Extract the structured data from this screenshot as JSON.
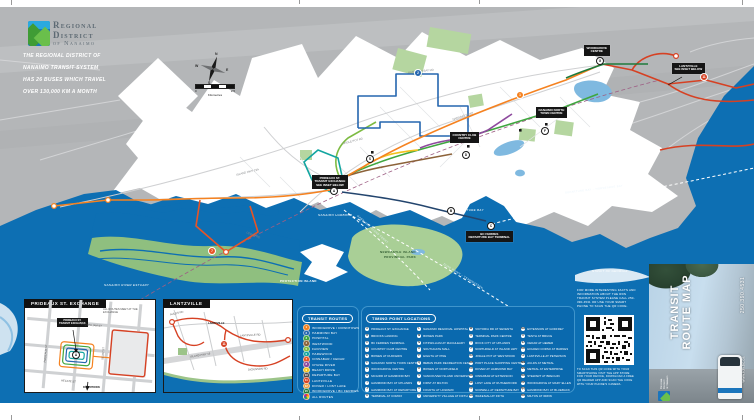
{
  "brand": {
    "line1": "Regional",
    "line2": "District",
    "line3": "of Nanaimo",
    "tagline": [
      "THE REGIONAL DISTRICT OF",
      "NANAIMO TRANSIT SYSTEM",
      "HAS 26 BUSES WHICH TRAVEL",
      "OVER 130,000 KM A MONTH"
    ]
  },
  "map": {
    "compass": {
      "n": "N",
      "e": "E",
      "s": "S",
      "w": "W"
    },
    "scale": {
      "zero": "0",
      "max": "2.5",
      "unit": "Kilometres"
    },
    "callouts": {
      "prideaux": {
        "l1": "PRIDEAUX ST.",
        "l2": "TRANSIT EXCHANGE",
        "l3": "SEE INSET BELOW"
      },
      "lantzville": {
        "l1": "LANTZVILLE",
        "l2": "SEE INSET BELOW"
      },
      "bcferries": {
        "l1": "BC FERRIES",
        "l2": "DEPARTURE BAY TERMINAL"
      },
      "woodgrove": {
        "l1": "WOODGROVE",
        "l2": "CENTRE"
      },
      "ntc": {
        "l1": "NANAIMO NORTH",
        "l2": "TOWN CENTRE"
      },
      "ccc": {
        "l1": "COUNTRY CLUB",
        "l2": "CENTRE"
      }
    },
    "water": {
      "harbour": "NANAIMO HARBOUR",
      "departure_bay": "DEPARTURE BAY",
      "newcastle1": "NEWCASTLE ISLAND",
      "newcastle2": "PROVINCIAL PARK",
      "protection": "PROTECTION ISLAND",
      "estuary": "NANAIMO RIVER ESTUARY",
      "strait": "STRAIT OF GEORGIA"
    },
    "ferry": {
      "f1": "DEPARTURE BAY – HORSESHOE BAY",
      "f2": "DUKE POINT – TSAWWASSEN",
      "f3": "GABRIOLA ISLAND FERRY"
    },
    "roads": {
      "island_hwy": "ISLAND HWY 19A",
      "parkway": "NANAIMO PKWY",
      "hammond_bay": "HAMMOND BAY RD",
      "cedar": "CEDAR RD",
      "jingle_pot": "JINGLE POT RD"
    },
    "markers": {
      "a": "A",
      "b": "B",
      "c": "C",
      "d": "D",
      "f": "F",
      "g": "G",
      "s": "S"
    },
    "badges": {
      "r1": "1",
      "r2": "2",
      "r7": "7",
      "r11": "11"
    }
  },
  "insets": [
    {
      "title": "PRIDEAUX ST. EXCHANGE",
      "marker": "A",
      "box1": "PRIDEAUX ST.",
      "box2": "TRANSIT EXCHANGE",
      "note": "ALL ROUTES MEET AT THE EXCHANGE",
      "downtown": "DOWNTOWN",
      "streets": {
        "fitzwilliam": "FITZWILLIAM ST",
        "prideaux": "PRIDEAUX ST",
        "selby": "SELBY ST",
        "hecate": "HECATE ST"
      }
    },
    {
      "title": "LANTZVILLE",
      "village": "LANTZVILLE",
      "badge": "11",
      "streets": {
        "lantzville_rd": "LANTZVILLE RD",
        "aulds": "AULDS RD",
        "dickinson": "DICKINSON RD",
        "island_hwy": "ISLAND HWY 19"
      }
    }
  ],
  "legend": {
    "routes": {
      "header": "TRANSIT ROUTES",
      "items": [
        {
          "num": "1",
          "label": "WOODGROVE / DOWNTOWN",
          "color": "#F58220"
        },
        {
          "num": "2",
          "label": "HAMMOND BAY",
          "color": "#2566AF"
        },
        {
          "num": "3",
          "label": "HOSPITAL",
          "color": "#3FA63F"
        },
        {
          "num": "4",
          "label": "WESTWOOD",
          "color": "#8C6239"
        },
        {
          "num": "5",
          "label": "FAIRVIEW",
          "color": "#7DBB42"
        },
        {
          "num": "6",
          "label": "HAREWOOD",
          "color": "#12A5A0"
        },
        {
          "num": "7",
          "label": "CINNABAR / CEDAR",
          "color": "#E85425"
        },
        {
          "num": "8",
          "label": "CHASE RIVER",
          "color": "#8E4A9E"
        },
        {
          "num": "9",
          "label": "BEACH DRIVE",
          "color": "#F2C21E"
        },
        {
          "num": "10",
          "label": "DEPARTURE BAY",
          "color": "#4A4A4C"
        },
        {
          "num": "11",
          "label": "LANTZVILLE",
          "color": "#D64123"
        },
        {
          "num": "12",
          "label": "DOVER / LOST LAKE",
          "color": "#F09A3C"
        },
        {
          "num": "15",
          "label": "WOODGROVE / BC FERRIES",
          "color": "#1E7A3C"
        },
        {
          "num": "",
          "label": "ALL ROUTES",
          "color": "multi"
        }
      ]
    },
    "timing": {
      "header": "TIMING POINT LOCATIONS",
      "columns": [
        [
          {
            "letter": "A",
            "label": "PRIDEAUX ST. EXCHANGE"
          },
          {
            "letter": "B",
            "label": "BROOKS LANDING"
          },
          {
            "letter": "C",
            "label": "BC FERRIES TERMINAL"
          },
          {
            "letter": "D",
            "label": "COUNTRY CLUB CENTRE"
          },
          {
            "letter": "E",
            "label": "BOWEN AT DUFFERIN"
          },
          {
            "letter": "F",
            "label": "NANAIMO NORTH TOWN CENTRE"
          },
          {
            "letter": "G",
            "label": "WOODGROVE CENTRE"
          },
          {
            "letter": "H",
            "label": "MCGIRR AT HAMMOND BAY"
          },
          {
            "letter": "I",
            "label": "HAMMOND BAY AT UPLANDS"
          },
          {
            "letter": "J",
            "label": "HAMMOND BAY AT DEPARTURE BAY"
          },
          {
            "letter": "K",
            "label": "TERMINAL AT COMOX"
          }
        ],
        [
          {
            "letter": "L",
            "label": "NANAIMO REGIONAL HOSPITAL"
          },
          {
            "letter": "M",
            "label": "BOWEN PARK"
          },
          {
            "letter": "N",
            "label": "FITZWILLIAM AT MACHLEARY"
          },
          {
            "letter": "O",
            "label": "SOUTHGATE MALL"
          },
          {
            "letter": "P",
            "label": "EIGHTH AT PINE"
          },
          {
            "letter": "Q",
            "label": "BEBAN PARK RECREATION CENTRE"
          },
          {
            "letter": "R",
            "label": "BOWEN AT NORTHFIELD"
          },
          {
            "letter": "S",
            "label": "VANCOUVER ISLAND UNIVERSITY"
          },
          {
            "letter": "T",
            "label": "FIRST AT MILTON"
          },
          {
            "letter": "U",
            "label": "FOURTH AT HOWARD"
          },
          {
            "letter": "V",
            "label": "UNIVERSITY VILLAGE AT FIFTH"
          }
        ],
        [
          {
            "letter": "W",
            "label": "VICTORIA RD AT SEVENTH"
          },
          {
            "letter": "X",
            "label": "TERMINAL PARK CENTRE"
          },
          {
            "letter": "Y",
            "label": "ROCK CITY AT UPLANDS"
          },
          {
            "letter": "Z",
            "label": "NORTHFIELD AT ISLAND HWY"
          },
          {
            "letter": "AA",
            "label": "JINGLE POT AT WESTWOOD"
          },
          {
            "letter": "BB",
            "label": "PORT PLACE SHOPPING CENTRE"
          },
          {
            "letter": "CC",
            "label": "DOVER AT HAMMOND BAY"
          },
          {
            "letter": "DD",
            "label": "CINNABAR AT EXTENSION"
          },
          {
            "letter": "EE",
            "label": "LOST LAKE AT RUTHERFORD"
          },
          {
            "letter": "FF",
            "label": "NORWELL AT DEPARTURE BAY"
          },
          {
            "letter": "GG",
            "label": "WAKESIAH AT FIFTH"
          }
        ],
        [
          {
            "letter": "HH",
            "label": "EXTENSION AT GODFREY"
          },
          {
            "letter": "II",
            "label": "TENTH AT BRUCE"
          },
          {
            "letter": "JJ",
            "label": "CEDAR AT HEMER"
          },
          {
            "letter": "KK",
            "label": "HOLDEN CORSO AT BARNES"
          },
          {
            "letter": "LL",
            "label": "LANTZVILLE AT PETERSON"
          },
          {
            "letter": "MM",
            "label": "AULDS AT METRAL"
          },
          {
            "letter": "NN",
            "label": "METRAL AT ENTERPRISE"
          },
          {
            "letter": "OO",
            "label": "STEWART AT BRECHIN"
          },
          {
            "letter": "PP",
            "label": "WOODGROVE AT MARY ELLEN"
          },
          {
            "letter": "QQ",
            "label": "HAMMOND BAY AT BLUEBACK"
          },
          {
            "letter": "RR",
            "label": "MILTON AT IRWIN"
          }
        ]
      ]
    }
  },
  "cover": {
    "promo": "For more interesting facts and information about the RDN Transit System please call 250-390-4531 or use your smart phone to scan the QR code.",
    "qr_note": "To scan this QR code with your smartphone visit the app store for your device, download a free QR reader app and scan the code with your phone's camera.",
    "title1": "TRANSIT",
    "title2": "ROUTE MAP",
    "phone": "250.390.4531",
    "web": "www.rdn.bc.ca",
    "logo1": "Regional",
    "logo2": "District",
    "logo3": "of Nanaimo"
  }
}
